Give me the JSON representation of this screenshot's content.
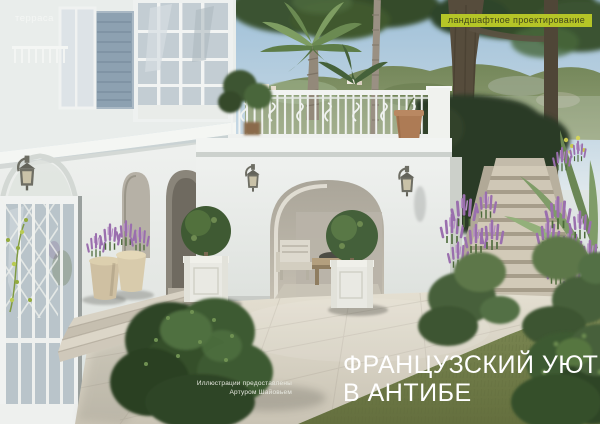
{
  "page": {
    "section_label": "терраса",
    "badge": {
      "label": "ландшафтное проектирование",
      "bg_color": "#b5c527",
      "text_color": "#42471a"
    },
    "title": {
      "line1": "ФРАНЦУЗСКИЙ УЮТ",
      "line2": "В АНТИБЕ",
      "color": "#ffffff"
    },
    "credit": {
      "line1": "Иллюстрации предоставлены",
      "line2": "Артуром Шайовьем"
    }
  },
  "scene": {
    "description": "3D render: white French villa in Antibes with arched loggia, balcony with ornamental white iron railing, stone staircase flanked by purple salvia and green shrubs, palm trees, boxwood topiaries in white planters, lavender pots, stone paving and lawn",
    "palette": {
      "sky": "#a9c6da",
      "hills": "#74875a",
      "foliage_dark": "#2e4526",
      "foliage_light": "#5d7c49",
      "purple_flowers": "#9a6fae",
      "villa_white": "#e9edeb",
      "shutter_blue": "#8da1b1",
      "paving": "#d8d2c5",
      "grass": "#75814c",
      "terracotta": "#ad7b55",
      "accent_lime": "#b5c527"
    }
  }
}
